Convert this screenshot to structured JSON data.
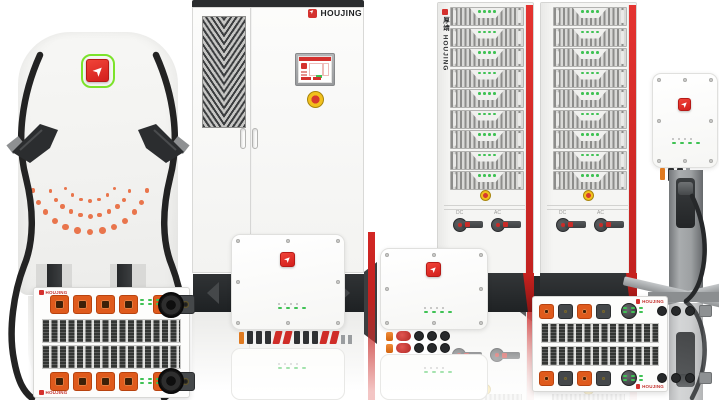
{
  "brand": {
    "name": "HOUJING",
    "vertical_name": "厚靖 HOUJING"
  },
  "colors": {
    "accent_red": "#D42826",
    "logo_green": "#7CE32B",
    "led_green": "#3FC254",
    "dot_orange": "#E86A3E",
    "connector_orange": "#DF5A1C",
    "plinth_dark": "#26292B",
    "cable_black": "#232323"
  },
  "left_charger": {
    "dot_arcs": [
      {
        "radius": 60,
        "count": 13
      },
      {
        "radius": 44,
        "count": 11
      },
      {
        "radius": 29,
        "count": 7
      }
    ]
  },
  "cabinet": {
    "brand_label": "HOUJING"
  },
  "battery_tower": {
    "module_count": 9,
    "module_led_count": 4,
    "switch_labels": [
      "DC",
      "AC"
    ]
  },
  "rack_left": {
    "brand_label": "HOUJING",
    "connectors": [
      "sq-orange",
      "sq-orange",
      "sq-orange",
      "sq-orange",
      "gap",
      "sq-orange",
      "sq-dark"
    ],
    "leds": {
      "rows": 2,
      "cols": 4,
      "gray": false
    }
  },
  "rack_right": {
    "brand_label": "HOUJING",
    "connectors": [
      "sq-orange",
      "sq-dark",
      "sq-orange",
      "sq-dark",
      "gap2",
      "knob",
      "gap3",
      "disc",
      "disc",
      "disc",
      "sq-gray"
    ],
    "leds": {
      "rows": 2,
      "cols": 3,
      "gray": false
    }
  },
  "wallbox_center": {
    "terminals": [
      "nub-orange",
      "bar",
      "bar",
      "bar",
      "bar-red",
      "bar-red",
      "bar",
      "bar",
      "bar",
      "bar-red",
      "bar-red",
      "nub-gray",
      "nub-gray"
    ],
    "leds": {
      "rows": 2,
      "cols": 4,
      "gray": true
    }
  },
  "wallbox_small": {
    "terminals": [
      "cyl-orange",
      "disc-red",
      "disc",
      "disc",
      "disc"
    ],
    "leds": {
      "rows": 2,
      "cols": 4,
      "gray": true
    }
  },
  "wallbox_right": {
    "terminals": [
      "nub-orange",
      "bar",
      "bar",
      "nub-gray"
    ],
    "leds": {
      "rows": 2,
      "cols": 4,
      "gray": true
    }
  }
}
